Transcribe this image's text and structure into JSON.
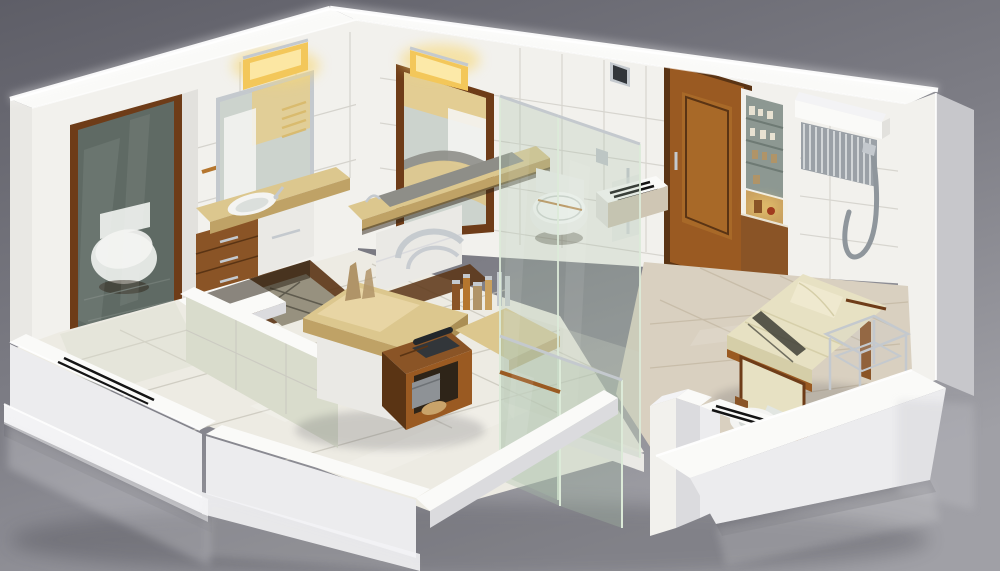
{
  "scene": {
    "subject": "isometric-3d-cutaway-render-of-bathroom-suite",
    "style": "photorealistic architectural visualization, white cutaway walls on gray studio backdrop",
    "rooms": [
      "left-toilet-room-behind-tinted-glass-sliding-door",
      "central-vanity-and-grooming-area",
      "glass-enclosed-toilet-shower-room",
      "right-lounge-room-with-massage-bed"
    ],
    "objects": [
      "tinted-glass-door-with-wood-frame",
      "wall-toilet-left",
      "silver-framed-mirror-cabinet",
      "warm-vanity-light-left",
      "marble-vanity-counter-with-sink",
      "wood-drawer-cabinet",
      "tiled-pony-wall",
      "marble-island-counter",
      "wood-side-table-with-telephone",
      "chrome-arch-decor",
      "toiletry-bottles",
      "mahogany-framed-mirror",
      "warm-vanity-light-center",
      "long-marble-counter-with-trough-sink",
      "glass-shower-partition",
      "wall-hung-toilet",
      "vent-ledge",
      "wood-panel-door",
      "light-switch",
      "built-in-shelving-unit",
      "warm-display-niche",
      "towel-warmer-radiator-with-hose",
      "massage-bed-with-pillow",
      "chrome-glass-side-table",
      "top-view-toilet",
      "sliding-door-tracks",
      "glossy-tile-floors"
    ]
  },
  "palette": {
    "bg_top": "#5e5e67",
    "bg_mid": "#7d7d85",
    "bg_bottom": "#a0a0a6",
    "ground_shadow": "#34343c",
    "wall_white": "#f2f1ed",
    "wall_band": "#fafaf8",
    "wall_bright": "#ffffff",
    "wall_shade": "#e2e1dd",
    "wall_margin": "#e9e8e4",
    "outer_light": "#ececee",
    "outer_mid": "#dbdbde",
    "outer_dark": "#c7c7cb",
    "plinth": "#f3f3f5",
    "under_shadow": "#6e6e76",
    "grout": "#c9c7c0",
    "grout_floor": "#c7c4b9",
    "grout_beige": "#c1b5a0",
    "floor_white": "#edebe3",
    "floor_beige": "#d9d0c0",
    "sheen": "#ffffff",
    "tile_green": "#d9dccc",
    "glass_dark": "#5f6a64",
    "glass_light": "#a9bfa9",
    "glass_edge": "#dcead8",
    "chrome": "#c4c9ce",
    "wood_frame": "#6e3c18",
    "wood_door": "#9a5a22",
    "wood_door_light": "#b5762e",
    "wood_cabinet": "#8a5426",
    "wood_dark": "#5a3414",
    "marble": "#dcc78e",
    "marble_light": "#ecdcae",
    "marble_dark": "#bfa266",
    "marble_deep": "#ab8f55",
    "porcelain": "#f4f4f2",
    "porcelain_shade": "#d5d9d6",
    "porcelain_dim": "#e2e6e2",
    "light_fixture": "#f3c75a",
    "light_core": "#fce9a8",
    "glow": "#f7d878",
    "mirror_glass": "#ccd3cd",
    "mirror_warm": "#e8cc84",
    "ladder": "#d9b96a",
    "shelf_gray": "#8d9892",
    "shelf_dark": "#6e7a74",
    "niche_warm": "#c9a05e",
    "radiator": "#9ba1a7",
    "radiator_slat": "#eceff1",
    "hose": "#8f969c",
    "mattress": "#e7e1c3",
    "mattress_edge": "#d5cea8",
    "pillow": "#efe9cf",
    "stripe": "#3e3e36",
    "track": "#141414",
    "sill": "#cfc6b4",
    "gap_dark": "#2e2418",
    "box_gray": "#8e9296",
    "loofah": "#c9a36a",
    "phone": "#32363a",
    "phone_dark": "#23272b",
    "rug": "#97917f",
    "rug_line": "#5f5b4e",
    "trough": "#8e8e88",
    "cabinet_white": "#eae9e5",
    "item_light": "#e8e2d2",
    "item_dark": "#b09468",
    "accent_red": "#a03a1e",
    "floor_line_dim": "#76807a",
    "seam": "#6e7276"
  }
}
